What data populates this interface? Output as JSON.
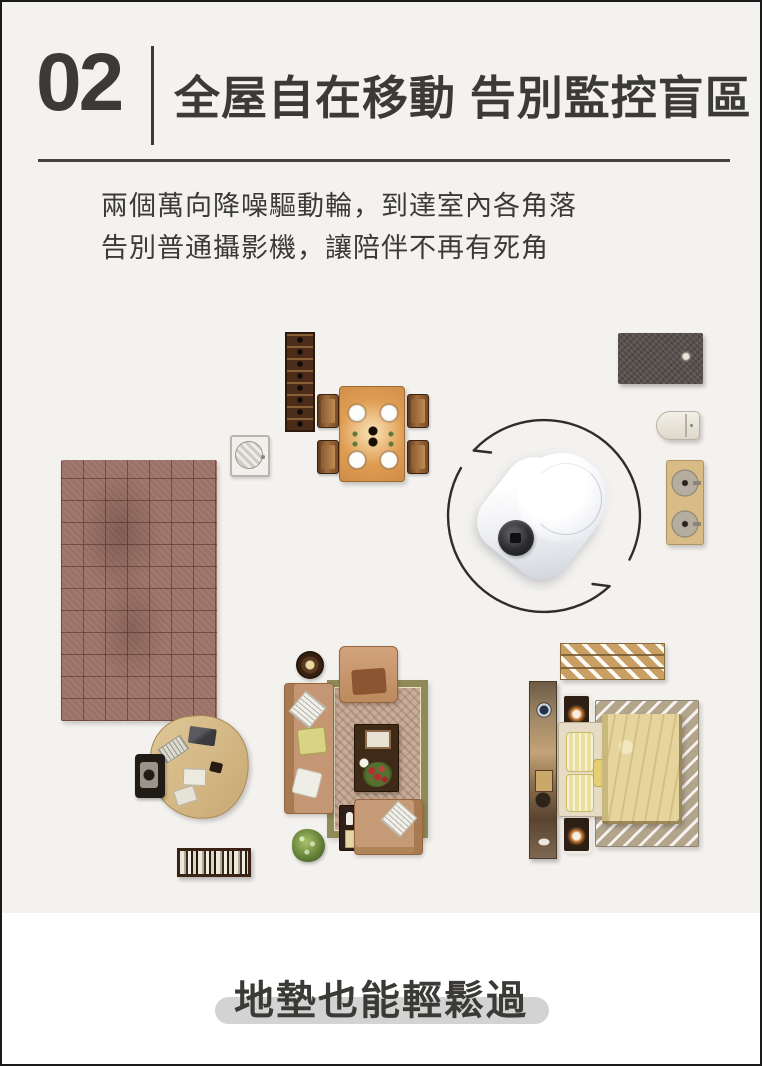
{
  "page": {
    "background_top": "#f4f2ef",
    "background_bottom": "#ffffff",
    "frame_color": "#1a1a1a",
    "text_color": "#3b3a36"
  },
  "header": {
    "section_number": "02",
    "title": "全屋自在移動 告別監控盲區"
  },
  "intro": {
    "line1": "兩個萬向降噪驅動輪，到達室內各角落",
    "line2": "告別普通攝影機，讓陪伴不再有死角"
  },
  "floorplan": {
    "furniture_icons": [
      "wine-rack-icon",
      "air-vent-icon",
      "dining-table-icon",
      "dining-chair-icon",
      "tiled-rug-icon",
      "bath-mat-icon",
      "toilet-icon",
      "double-sink-icon",
      "drying-rack-icon",
      "wardrobe-icon",
      "nightstand-icon",
      "bed-icon",
      "striped-rug-icon",
      "area-rug-icon",
      "armchair-icon",
      "sofa-icon",
      "coffee-table-icon",
      "loveseat-icon",
      "side-table-icon",
      "plant-icon",
      "round-table-icon",
      "desk-icon",
      "desk-chair-icon",
      "bookshelf-icon"
    ],
    "robot": {
      "glow_color": "#8ea2d6",
      "body_color": "#ffffff",
      "lens_color": "#2c2c30",
      "arrow_color": "#2f2d2a"
    }
  },
  "footer": {
    "headline": "地墊也能輕鬆過",
    "pill_color": "#d3d3d3"
  }
}
